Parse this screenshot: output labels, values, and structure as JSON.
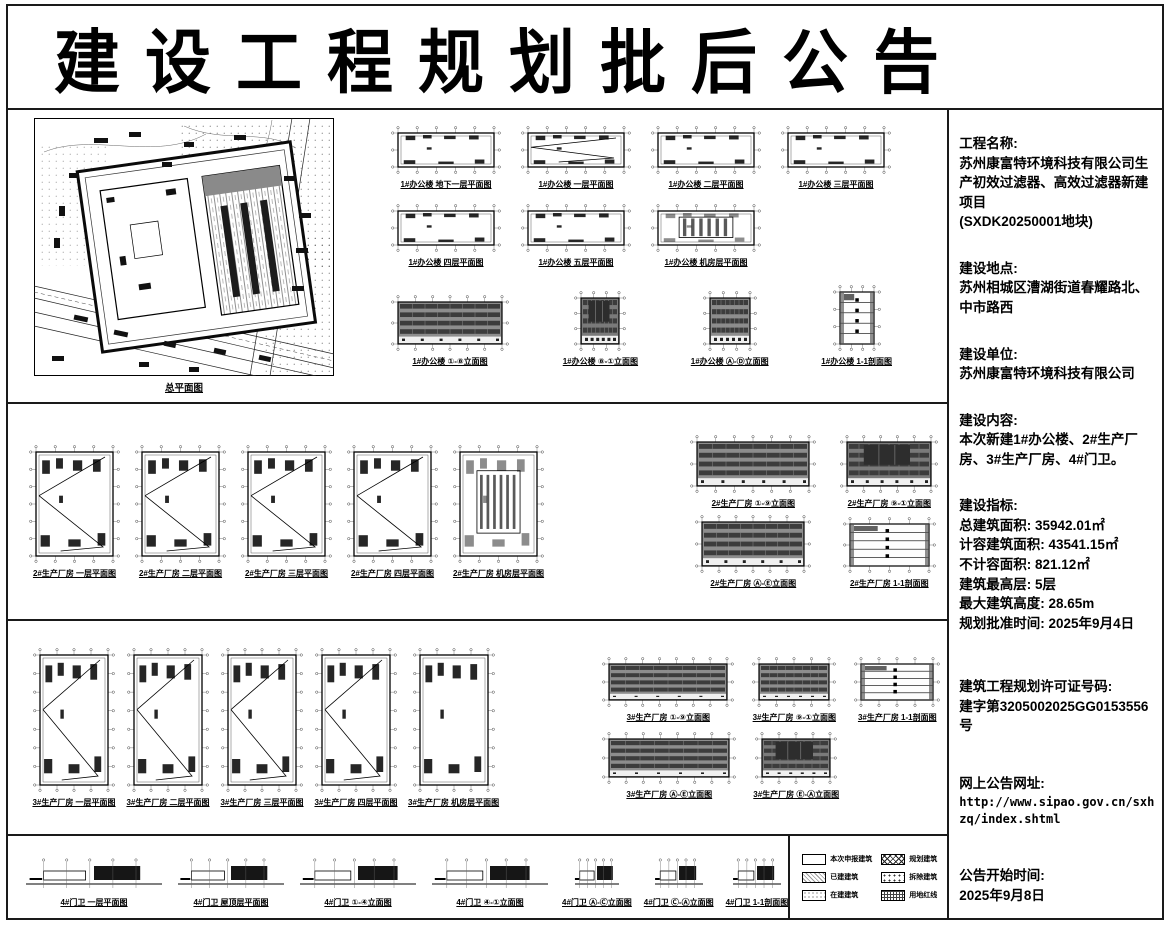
{
  "colors": {
    "ink": "#111111",
    "paper": "#ffffff"
  },
  "title": "建设工程规划批后公告",
  "site_plan": {
    "caption": "总平面图"
  },
  "bands": {
    "office": {
      "plans_row1": [
        "1#办公楼 地下一层平面图",
        "1#办公楼 一层平面图",
        "1#办公楼 二层平面图",
        "1#办公楼 三层平面图"
      ],
      "plans_row2": [
        "1#办公楼 四层平面图",
        "1#办公楼 五层平面图",
        "1#办公楼 机房层平面图"
      ],
      "elevs": [
        "1#办公楼 ①-⑧立面图",
        "1#办公楼 ⑧-①立面图",
        "1#办公楼 Ⓐ-Ⓓ立面图",
        "1#办公楼 1-1剖面图"
      ]
    },
    "factory2": {
      "plans": [
        "2#生产厂房 一层平面图",
        "2#生产厂房 二层平面图",
        "2#生产厂房 三层平面图",
        "2#生产厂房 四层平面图",
        "2#生产厂房 机房层平面图"
      ],
      "elevs": [
        "2#生产厂房 ①-⑨立面图",
        "2#生产厂房 ⑨-①立面图",
        "2#生产厂房 Ⓐ-Ⓔ立面图",
        "2#生产厂房 1-1剖面图"
      ]
    },
    "factory3": {
      "plans": [
        "3#生产厂房 一层平面图",
        "3#生产厂房 二层平面图",
        "3#生产厂房 三层平面图",
        "3#生产厂房 四层平面图",
        "3#生产厂房 机房层平面图"
      ],
      "elevs_row1": [
        "3#生产厂房 ①-⑨立面图",
        "3#生产厂房 ⑨-①立面图",
        "3#生产厂房 1-1剖面图"
      ],
      "elevs_row2": [
        "3#生产厂房 Ⓐ-Ⓔ立面图",
        "3#生产厂房 Ⓔ-Ⓐ立面图"
      ]
    },
    "guard": {
      "items": [
        "4#门卫 一层平面图",
        "4#门卫 屋顶层平面图",
        "4#门卫 ①-④立面图",
        "4#门卫 ④-①立面图",
        "4#门卫 Ⓐ-Ⓒ立面图",
        "4#门卫 Ⓒ-Ⓐ立面图",
        "4#门卫 1-1剖面图"
      ]
    }
  },
  "legend": {
    "items": [
      "本次申报建筑",
      "已建建筑",
      "在建建筑",
      "规划建筑",
      "拆除建筑",
      "用地红线"
    ]
  },
  "info": {
    "blocks": [
      {
        "label": "工程名称:",
        "body": "苏州康富特环境科技有限公司生产初效过滤器、高效过滤器新建项目\n(SXDK20250001地块)"
      },
      {
        "label": "建设地点:",
        "body": "苏州相城区漕湖街道春耀路北、中市路西"
      },
      {
        "label": "建设单位:",
        "body": "苏州康富特环境科技有限公司"
      },
      {
        "label": "建设内容:",
        "body": "本次新建1#办公楼、2#生产厂房、3#生产厂房、4#门卫。"
      },
      {
        "label": "建设指标:",
        "body": "总建筑面积: 35942.01㎡\n计容建筑面积: 43541.15㎡\n不计容面积: 821.12㎡\n建筑最高层: 5层\n最大建筑高度: 28.65m\n规划批准时间: 2025年9月4日"
      },
      {
        "label": "建筑工程规划许可证号码:",
        "body": "建字第3205002025GG0153556号"
      },
      {
        "label": "网上公告网址:",
        "body": "http://www.sipao.gov.cn/sxhzq/index.shtml"
      },
      {
        "label": "公告开始时间:",
        "body": "2025年9月8日"
      }
    ]
  }
}
